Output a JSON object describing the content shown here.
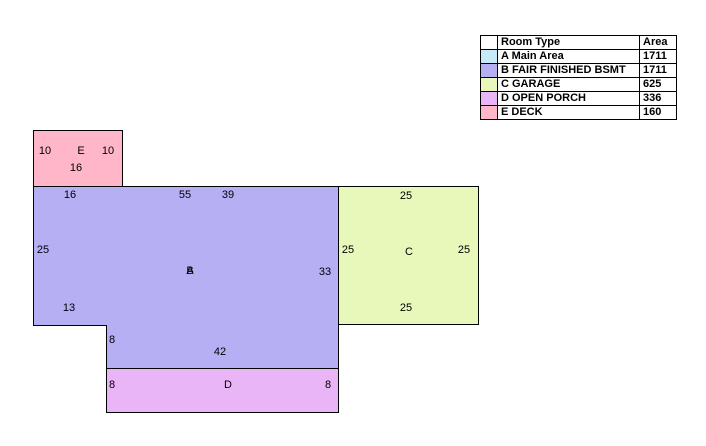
{
  "page": {
    "background": "#ffffff",
    "border_color": "#000000"
  },
  "legend_table": {
    "headers": {
      "swatch": "",
      "room_type": "Room Type",
      "area": "Area"
    },
    "rows": [
      {
        "color": "#C5EAF8",
        "room_type": "A Main Area",
        "area": "1711"
      },
      {
        "color": "#B6AFF4",
        "room_type": "B FAIR FINISHED BSMT",
        "area": "1711"
      },
      {
        "color": "#E8F8BB",
        "room_type": "C GARAGE",
        "area": "625"
      },
      {
        "color": "#E9B5F6",
        "room_type": "D OPEN PORCH",
        "area": "336"
      },
      {
        "color": "#FFB6C9",
        "room_type": "E DECK",
        "area": "160"
      }
    ]
  },
  "sketch": {
    "rooms": {
      "A": {
        "label": "A",
        "color": "#C5EAF8"
      },
      "B": {
        "label": "B",
        "color": "#B6AFF4",
        "dims": {
          "top_left": "16",
          "top_mid": "55",
          "top_right": "39",
          "left": "25",
          "right": "33",
          "bottom_left": "13",
          "ext_left": "8",
          "ext_bottom": "42"
        }
      },
      "C": {
        "label": "C",
        "color": "#E8F8BB",
        "dims": {
          "top": "25",
          "left": "25",
          "right": "25",
          "bottom": "25"
        }
      },
      "D": {
        "label": "D",
        "color": "#E9B5F6",
        "dims": {
          "left": "8",
          "right": "8"
        }
      },
      "E": {
        "label": "E",
        "color": "#FFB6C9",
        "dims": {
          "left": "10",
          "right": "10",
          "bottom": "16"
        }
      }
    }
  }
}
